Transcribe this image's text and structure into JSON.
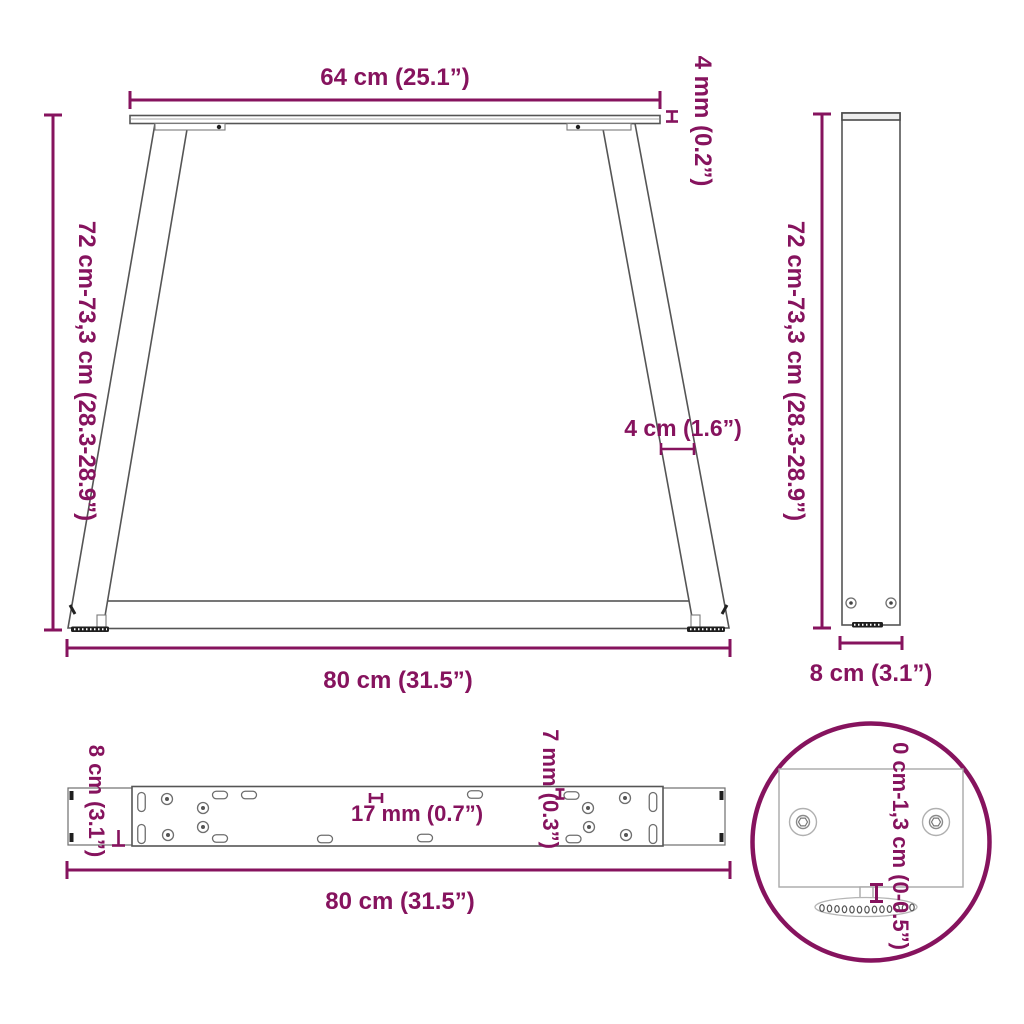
{
  "meta": {
    "description": "Technical dimension drawing of V-shape table legs, four views"
  },
  "colors": {
    "accent": "#86135E",
    "part_outline": "#555555",
    "part_outline_light": "#a9a9a9",
    "dark_detail": "#1f1f1f",
    "background": "#ffffff"
  },
  "front_view": {
    "top_width": "64 cm (25.1”)",
    "plate_thickness": "4 mm (0.2”)",
    "height_range": "72 cm-73,3 cm (28.3-28.9”)",
    "leg_width": "4 cm (1.6”)",
    "bottom_width": "80 cm (31.5”)"
  },
  "side_view": {
    "height_range": "72 cm-73,3 cm (28.3-28.9”)",
    "depth": "8 cm (3.1”)"
  },
  "plate_view": {
    "depth": "8 cm (3.1”)",
    "slot_width": "17 mm (0.7”)",
    "hole_diameter": "7 mm (0.3”)",
    "length": "80 cm (31.5”)"
  },
  "detail_view": {
    "adjustment_range": "0 cm-1,3 cm (0-0.5”)"
  }
}
